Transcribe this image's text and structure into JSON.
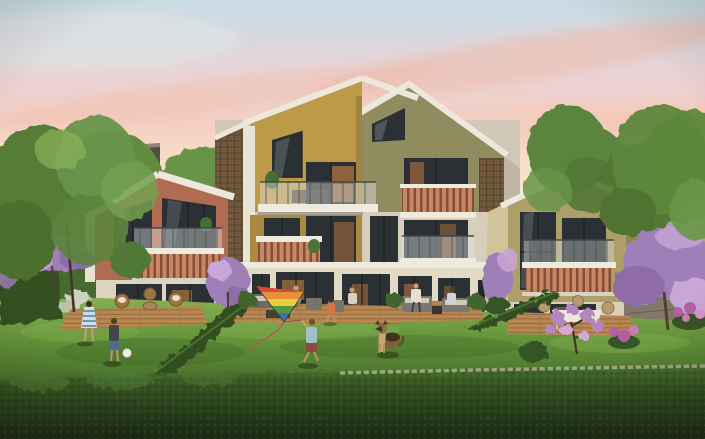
{
  "meta": {
    "description": "Sunset architectural rendering of a modern residential complex: three gabled townhouse volumes with mustard, terracotta and olive facades, terracotta-slat balconies, garden decks, green lawn, clipped hedges, blooming purple trees and people enjoying the shared garden",
    "time_of_day": "sunset"
  },
  "palette": {
    "sky_top": "#c8dde9",
    "sky_pink": "#f4cfc3",
    "sky_horizon": "#fcf3e4",
    "cloud": "#f0bfb2",
    "fascia": "#eceadf",
    "mustard": "#bb9845",
    "mustard_dark": "#a8873c",
    "olive_gable": "#8d895e",
    "gray_facade": "#d6d0be",
    "cream": "#e2dbc8",
    "terracotta_house": "#ad6950",
    "right_house": "#ab9d67",
    "right_house_shadow": "#8e8356",
    "return_wall": "#cfc49b",
    "lattice": "#6f5539",
    "slat": "#c58463",
    "slat_gap": "#7e4a33",
    "window_dark": "#232a30",
    "window_glow": "#e0893e",
    "glass": "#dfe9ec",
    "slab": "#efece1",
    "deck_wood": "#b5854c",
    "lawn": "#5c8f35",
    "lawn_light": "#7fae4c",
    "lawn_dark": "#3a6325",
    "hedge": "#2a4a1c",
    "hedge_dark": "#142a0e",
    "hedge_light": "#4e7e30",
    "stone_cap": "#a8ad93",
    "stone_wall": "#7d7466",
    "tree_green": "#5e8a3b",
    "tree_green_dark": "#44682e",
    "tree_green_light": "#7fae52",
    "purple_tree": "#9c7cba",
    "purple_light": "#c6a5da",
    "magenta_flower": "#b05aa5",
    "trunk": "#4a3b2a",
    "bg_building_dark": "#4e4939",
    "bg_building_tan": "#b2a47a",
    "skin": "#c89a7a",
    "ball": "#eff0ea",
    "dog_brown": "#7a5c38",
    "dog_dark": "#3a2b1a",
    "kite_red": "#d8453a",
    "kite_orange": "#e88f35",
    "kite_yellow": "#e8cf3c",
    "kite_green": "#4d9a40",
    "kite_blue": "#3b6cb4"
  },
  "scene": {
    "buildings": {
      "left_house": {
        "facade": "terracotta",
        "stories": 2,
        "balcony": "glass rail over terracotta slats",
        "ground": "glass doors with warm interior light, rattan chairs on wood deck"
      },
      "center_block": {
        "facade": "mustard and light grey",
        "stories": 3,
        "gables": 2,
        "details": [
          "brown lattice brick screens",
          "glass-rail balcony",
          "terracotta slat balconies",
          "lounge decks with residents"
        ]
      },
      "right_house": {
        "facade": "olive tan",
        "stories": 2,
        "balcony": "terracotta slats",
        "ground": "white garden table on wood deck"
      }
    },
    "background": {
      "left": "dark low-rise behind green trees",
      "right": "tan house behind stone wall and purple tree"
    },
    "garden": {
      "lawn": "sloped sunlit lawn",
      "foreground_hedge": "tall clipped hedge with stone cap",
      "diagonal_hedges": 2,
      "purple_trees": 5,
      "flower_clusters": "magenta shrubs"
    },
    "figures": [
      {
        "name": "girl-striped-dress",
        "action": "walking"
      },
      {
        "name": "boy-with-football",
        "ball": "white"
      },
      {
        "name": "boy-flying-kite",
        "kite": "rainbow delta kite"
      },
      {
        "name": "child-running"
      },
      {
        "name": "shepherd-dog",
        "action": "sitting on lawn"
      },
      {
        "name": "man-seated-on-deck"
      },
      {
        "name": "woman-seated-on-deck"
      },
      {
        "name": "residents-on-balconies"
      }
    ]
  }
}
